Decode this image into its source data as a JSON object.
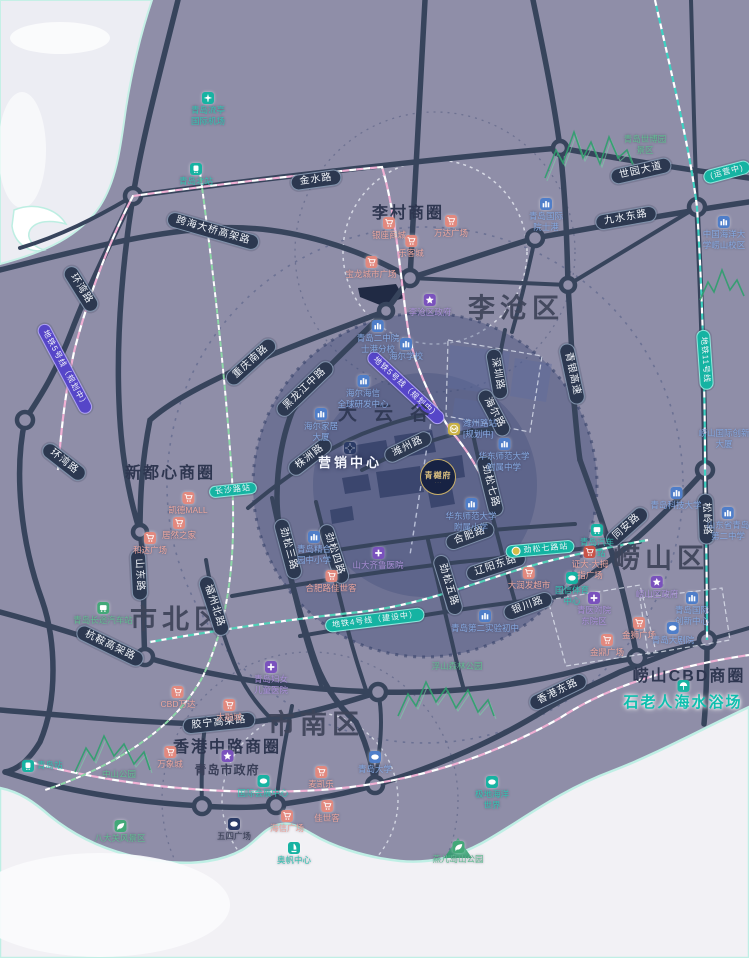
{
  "colors": {
    "land": "#8f8ea8",
    "water": "#f2f1f5",
    "road": "#37445c",
    "pill_bg": "#2c3850",
    "metro_purple": "#5646c8",
    "metro_teal": "#15b3a2",
    "highlight_circle": "#2f3e6e",
    "poi_pink": "#e2897f",
    "poi_blue": "#4f7ec9",
    "poi_purple": "#7a52bd",
    "poi_teal": "#17b3a2",
    "poi_green": "#43a878",
    "beach_teal": "#0fbfae"
  },
  "districts": [
    {
      "label": "李沧区",
      "x": 516,
      "y": 306
    },
    {
      "label": "崂山区",
      "x": 661,
      "y": 556
    },
    {
      "label": "市北区",
      "x": 178,
      "y": 617
    },
    {
      "label": "市南区",
      "x": 316,
      "y": 722
    }
  ],
  "business_circles": [
    {
      "label": "李村商圈",
      "x": 408,
      "y": 211
    },
    {
      "label": "新都心商圈",
      "x": 170,
      "y": 471
    },
    {
      "label": "香港中路商圈",
      "x": 227,
      "y": 745
    },
    {
      "label": "崂山CBD商圈",
      "x": 689,
      "y": 674
    }
  ],
  "dayungu": {
    "label": "大云谷",
    "x": 392,
    "y": 412
  },
  "logo": {
    "text": "青樾府",
    "sub": "· · ·",
    "x": 438,
    "y": 477
  },
  "road_pills": [
    {
      "label": "金水路",
      "x": 316,
      "y": 180,
      "r": -8
    },
    {
      "label": "跨海大桥高架路",
      "x": 213,
      "y": 231,
      "r": 16
    },
    {
      "label": "世园大道",
      "x": 641,
      "y": 171,
      "r": -13
    },
    {
      "label": "九水东路",
      "x": 626,
      "y": 218,
      "r": -10
    },
    {
      "label": "环湾路",
      "x": 81,
      "y": 289,
      "r": 58
    },
    {
      "label": "环湾路",
      "x": 64,
      "y": 462,
      "r": 38
    },
    {
      "label": "重庆南路",
      "x": 251,
      "y": 362,
      "r": -42
    },
    {
      "label": "青银高速",
      "x": 572,
      "y": 374,
      "r": 78
    },
    {
      "label": "黑龙江中路",
      "x": 305,
      "y": 389,
      "r": -44
    },
    {
      "label": "株洲路",
      "x": 310,
      "y": 457,
      "r": -38
    },
    {
      "label": "潍州路",
      "x": 408,
      "y": 447,
      "r": -26
    },
    {
      "label": "深圳路",
      "x": 497,
      "y": 374,
      "r": 80
    },
    {
      "label": "海尔路",
      "x": 494,
      "y": 413,
      "r": 62
    },
    {
      "label": "劲松七路",
      "x": 490,
      "y": 486,
      "r": 76
    },
    {
      "label": "同安路",
      "x": 627,
      "y": 527,
      "r": -42
    },
    {
      "label": "松岭路",
      "x": 706,
      "y": 519,
      "r": 88
    },
    {
      "label": "山东路",
      "x": 139,
      "y": 575,
      "r": 87
    },
    {
      "label": "福州北路",
      "x": 214,
      "y": 606,
      "r": 72
    },
    {
      "label": "劲松三路",
      "x": 288,
      "y": 549,
      "r": 75
    },
    {
      "label": "劲松四路",
      "x": 334,
      "y": 554,
      "r": 72
    },
    {
      "label": "劲松五路",
      "x": 448,
      "y": 585,
      "r": 73
    },
    {
      "label": "合肥路",
      "x": 470,
      "y": 536,
      "r": -20
    },
    {
      "label": "辽阳东路",
      "x": 496,
      "y": 566,
      "r": -18
    },
    {
      "label": "银川路",
      "x": 528,
      "y": 606,
      "r": -20
    },
    {
      "label": "杭鞍高架路",
      "x": 110,
      "y": 646,
      "r": 26
    },
    {
      "label": "胶宁高架路",
      "x": 219,
      "y": 723,
      "r": -6
    },
    {
      "label": "香港东路",
      "x": 558,
      "y": 692,
      "r": -26
    }
  ],
  "metro_pills": [
    {
      "label": "地铁5号线（规划中）",
      "x": 65,
      "y": 369,
      "r": 62,
      "style": "purple"
    },
    {
      "label": "地铁5号线（规划中）",
      "x": 406,
      "y": 388,
      "r": 43,
      "style": "purple"
    },
    {
      "label": "地铁11号线",
      "x": 705,
      "y": 360,
      "r": 86,
      "style": "teal"
    },
    {
      "label": "地铁4号线（建设中）",
      "x": 375,
      "y": 620,
      "r": -7,
      "style": "teal"
    },
    {
      "label": "(运营中)",
      "x": 727,
      "y": 172,
      "r": -15,
      "style": "teal"
    }
  ],
  "station_pills": [
    {
      "label": "劲松七路站",
      "x": 540,
      "y": 549,
      "r": -5,
      "dot": true
    },
    {
      "label": "长沙路站",
      "x": 233,
      "y": 490,
      "r": -6,
      "dot": false
    }
  ],
  "pois": [
    {
      "icon": "plane",
      "c": "teal",
      "tc": "teal",
      "x": 208,
      "y": 92,
      "lines": [
        "青岛流亭",
        "国际机场"
      ]
    },
    {
      "icon": "train",
      "c": "teal",
      "tc": "teal",
      "x": 196,
      "y": 163,
      "lines": [
        "青岛北站"
      ]
    },
    {
      "icon": "none",
      "c": "green",
      "tc": "green",
      "x": 645,
      "y": 134,
      "lines": [
        "青岛世博园",
        "景区"
      ]
    },
    {
      "icon": "school",
      "c": "blue",
      "tc": "blue",
      "x": 546,
      "y": 198,
      "lines": [
        "青岛国际",
        "院士港"
      ]
    },
    {
      "icon": "school",
      "c": "blue",
      "tc": "blue",
      "x": 724,
      "y": 216,
      "lines": [
        "中国海洋大",
        "学崂山校区"
      ]
    },
    {
      "icon": "cart",
      "c": "pink",
      "tc": "pink",
      "x": 389,
      "y": 217,
      "lines": [
        "银座商城"
      ]
    },
    {
      "icon": "cart",
      "c": "pink",
      "tc": "pink",
      "x": 451,
      "y": 215,
      "lines": [
        "万达广场"
      ]
    },
    {
      "icon": "cart",
      "c": "pink",
      "tc": "pink",
      "x": 411,
      "y": 235,
      "lines": [
        "乐客城"
      ]
    },
    {
      "icon": "cart",
      "c": "pink",
      "tc": "pink",
      "x": 371,
      "y": 256,
      "lines": [
        "宝龙城市广场"
      ]
    },
    {
      "icon": "star5",
      "c": "purple",
      "tc": "purple",
      "x": 430,
      "y": 294,
      "lines": [
        "李沧区政府"
      ]
    },
    {
      "icon": "school",
      "c": "blue",
      "tc": "blue",
      "x": 378,
      "y": 320,
      "lines": [
        "青岛二中院",
        "士港分校"
      ]
    },
    {
      "icon": "school",
      "c": "blue",
      "tc": "blue",
      "x": 406,
      "y": 338,
      "lines": [
        "海尔学校"
      ]
    },
    {
      "icon": "school",
      "c": "blue",
      "tc": "blue",
      "x": 363,
      "y": 375,
      "lines": [
        "海尔海信",
        "全球研发中心"
      ]
    },
    {
      "icon": "school",
      "c": "blue",
      "tc": "blue",
      "x": 321,
      "y": 408,
      "lines": [
        "海尔家居",
        "大厦"
      ]
    },
    {
      "icon": "school",
      "c": "blue",
      "tc": "blue",
      "x": 504,
      "y": 438,
      "lines": [
        "华东师范大学",
        "附属中学"
      ]
    },
    {
      "icon": "school",
      "c": "blue",
      "tc": "blue",
      "x": 471,
      "y": 498,
      "lines": [
        "华东师范大学",
        "附属小学"
      ]
    },
    {
      "icon": "compass",
      "c": "navy",
      "tc": "white",
      "cls": "sales",
      "x": 350,
      "y": 442,
      "lines": [
        "营销中心"
      ]
    },
    {
      "icon": "metro",
      "c": "yellow",
      "tc": "blue",
      "side": true,
      "x": 448,
      "y": 429,
      "lines": [
        "潍州路站",
        "[规划中]"
      ]
    },
    {
      "icon": "cross",
      "c": "purple",
      "tc": "purple",
      "x": 378,
      "y": 547,
      "lines": [
        "山大齐鲁医院"
      ]
    },
    {
      "icon": "school",
      "c": "blue",
      "tc": "blue",
      "x": 314,
      "y": 531,
      "lines": [
        "青岛精合",
        "园中小学"
      ]
    },
    {
      "icon": "cart",
      "c": "pink",
      "tc": "pink",
      "x": 331,
      "y": 570,
      "lines": [
        "合肥路佳世客"
      ]
    },
    {
      "icon": "cart",
      "c": "pink",
      "tc": "pink",
      "x": 529,
      "y": 567,
      "lines": [
        "大润发超市"
      ]
    },
    {
      "icon": "school",
      "c": "blue",
      "tc": "blue",
      "x": 485,
      "y": 610,
      "lines": [
        "青岛第二实验初中"
      ]
    },
    {
      "icon": "none",
      "c": "green",
      "tc": "green",
      "x": 457,
      "y": 661,
      "lines": [
        "浮山森林公园"
      ]
    },
    {
      "icon": "blob",
      "c": "teal",
      "tc": "teal",
      "x": 572,
      "y": 572,
      "lines": [
        "国信体育",
        "中心"
      ]
    },
    {
      "icon": "cross",
      "c": "purple",
      "tc": "purple",
      "x": 594,
      "y": 592,
      "lines": [
        "青医附院",
        "东院区"
      ]
    },
    {
      "icon": "star5",
      "c": "purple",
      "tc": "purple",
      "x": 657,
      "y": 576,
      "lines": [
        "崂山区政府"
      ]
    },
    {
      "icon": "school",
      "c": "blue",
      "tc": "blue",
      "x": 692,
      "y": 592,
      "lines": [
        "青岛国际",
        "创新中心"
      ]
    },
    {
      "icon": "cart",
      "c": "pink",
      "tc": "pink",
      "x": 639,
      "y": 617,
      "lines": [
        "金狮广场"
      ]
    },
    {
      "icon": "cart",
      "c": "pink",
      "tc": "pink",
      "x": 607,
      "y": 634,
      "lines": [
        "金鼎广场"
      ]
    },
    {
      "icon": "blob",
      "c": "blue",
      "tc": "blue",
      "x": 673,
      "y": 622,
      "lines": [
        "青岛大剧院"
      ]
    },
    {
      "icon": "school",
      "c": "blue",
      "tc": "blue",
      "x": 676,
      "y": 487,
      "lines": [
        "青岛科技大学"
      ]
    },
    {
      "icon": "school",
      "c": "blue",
      "tc": "blue",
      "x": 728,
      "y": 507,
      "lines": [
        "山东省青岛",
        "第二中学"
      ]
    },
    {
      "icon": "none",
      "c": "blue",
      "tc": "blue",
      "x": 724,
      "y": 428,
      "lines": [
        "崂山国际创新",
        "大厦"
      ]
    },
    {
      "icon": "bus",
      "c": "teal",
      "tc": "teal",
      "x": 597,
      "y": 524,
      "lines": [
        "青岛汽车",
        "东站"
      ]
    },
    {
      "icon": "cart",
      "c": "red",
      "tc": "pink",
      "x": 590,
      "y": 546,
      "lines": [
        "证大·大拇",
        "指广场"
      ]
    },
    {
      "icon": "cart",
      "c": "pink",
      "tc": "pink",
      "x": 188,
      "y": 492,
      "lines": [
        "凯德MALL"
      ]
    },
    {
      "icon": "cart",
      "c": "pink",
      "tc": "pink",
      "x": 179,
      "y": 517,
      "lines": [
        "居然之家"
      ]
    },
    {
      "icon": "cart",
      "c": "pink",
      "tc": "pink",
      "x": 150,
      "y": 532,
      "lines": [
        "和达广场"
      ]
    },
    {
      "icon": "bus",
      "c": "green",
      "tc": "green",
      "x": 103,
      "y": 602,
      "lines": [
        "青岛长途汽车站"
      ]
    },
    {
      "icon": "cross",
      "c": "purple",
      "tc": "purple",
      "x": 271,
      "y": 661,
      "lines": [
        "青岛妇女",
        "儿童医院"
      ]
    },
    {
      "icon": "cart",
      "c": "pink",
      "tc": "pink",
      "x": 178,
      "y": 686,
      "lines": [
        "CBD万达"
      ]
    },
    {
      "icon": "cart",
      "c": "pink",
      "tc": "pink",
      "x": 229,
      "y": 699,
      "lines": [
        "大融城"
      ]
    },
    {
      "icon": "cart",
      "c": "pink",
      "tc": "pink",
      "x": 170,
      "y": 746,
      "lines": [
        "万象城"
      ]
    },
    {
      "icon": "star5",
      "c": "purple",
      "tc": "dark",
      "cls": "gov-big",
      "x": 227,
      "y": 750,
      "lines": [
        "青岛市政府"
      ]
    },
    {
      "icon": "blob",
      "c": "blue",
      "tc": "blue",
      "x": 375,
      "y": 751,
      "lines": [
        "青岛大学"
      ]
    },
    {
      "icon": "cart",
      "c": "pink",
      "tc": "pink",
      "x": 321,
      "y": 766,
      "lines": [
        "麦凯乐"
      ]
    },
    {
      "icon": "cart",
      "c": "pink",
      "tc": "pink",
      "x": 327,
      "y": 800,
      "lines": [
        "佳世客"
      ]
    },
    {
      "icon": "cart",
      "c": "pink",
      "tc": "pink",
      "x": 287,
      "y": 810,
      "lines": [
        "海信广场"
      ]
    },
    {
      "icon": "sail",
      "c": "teal",
      "tc": "teal",
      "x": 294,
      "y": 842,
      "lines": [
        "奥帆中心"
      ]
    },
    {
      "icon": "blob",
      "c": "navy",
      "tc": "dark",
      "x": 234,
      "y": 818,
      "lines": [
        "五四广场"
      ]
    },
    {
      "icon": "train",
      "c": "teal",
      "tc": "teal",
      "side": true,
      "x": 22,
      "y": 766,
      "lines": [
        "青岛站"
      ]
    },
    {
      "icon": "none",
      "c": "green",
      "tc": "green",
      "x": 119,
      "y": 769,
      "lines": [
        "中山公园"
      ]
    },
    {
      "icon": "leaf",
      "c": "green",
      "tc": "green",
      "x": 120,
      "y": 820,
      "lines": [
        "八大关风景区"
      ]
    },
    {
      "icon": "blob",
      "c": "teal",
      "tc": "teal",
      "x": 492,
      "y": 776,
      "lines": [
        "极地海洋",
        "世界"
      ]
    },
    {
      "icon": "leaf",
      "c": "green",
      "tc": "green",
      "x": 458,
      "y": 841,
      "lines": [
        "燕儿岛山公园"
      ]
    },
    {
      "icon": "blob",
      "c": "teal",
      "tc": "teal",
      "x": 263,
      "y": 775,
      "lines": [
        "国际会展中心"
      ]
    },
    {
      "icon": "umb",
      "c": "teal",
      "tc": "teal",
      "cls": "bigteal",
      "x": 683,
      "y": 680,
      "lines": [
        "石老人海水浴场"
      ]
    }
  ]
}
